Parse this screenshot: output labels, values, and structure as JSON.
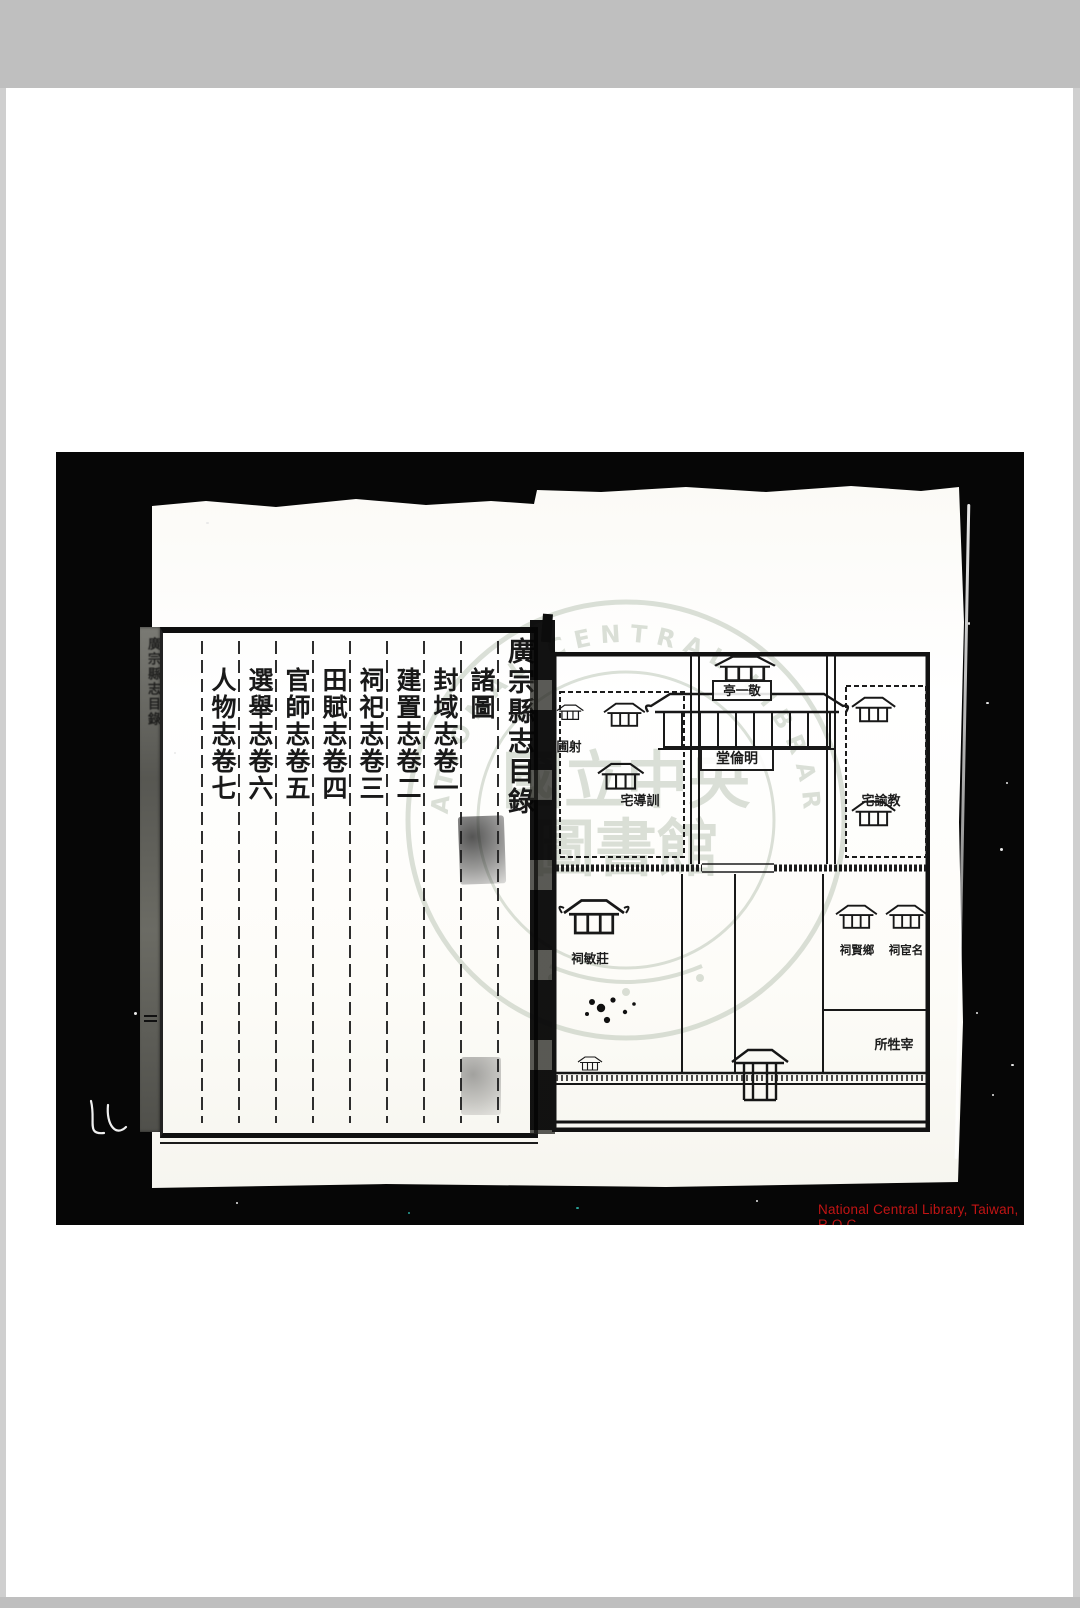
{
  "colors": {
    "viewer_frame": "#bfbfbf",
    "scan_background": "#060606",
    "paper": "#fbfaf6",
    "ink": "#191919",
    "credit_text": "#c21414",
    "watermark": "#b7c2b2"
  },
  "scan": {
    "left_page": {
      "spine_label": "廣宗縣志目錄",
      "title": "廣宗縣志目錄",
      "entries": [
        "諸圖",
        "封域志卷一",
        "建置志卷二",
        "祠祀志卷三",
        "田賦志卷四",
        "官師志卷五",
        "選舉志卷六",
        "人物志卷七"
      ]
    },
    "right_page": {
      "labels": {
        "pavilion": "亭一敬",
        "hall": "堂倫明",
        "archery": "圃射",
        "instructor_house": "宅導訓",
        "director_house": "宅諭教",
        "zhuangmin_shrine": "祠敏莊",
        "xiangxian_shrine": "祠賢鄉",
        "minghuan_shrine": "祠宦名",
        "slaughter_hall": "所牲宰"
      }
    },
    "watermark": {
      "ring_text": "NATIONAL CENTRAL LIBRARY",
      "seal_line1": "國立中央",
      "seal_line2": "圖書館"
    },
    "credit": {
      "text": "National Central Library, Taiwan, R.O.C."
    }
  }
}
